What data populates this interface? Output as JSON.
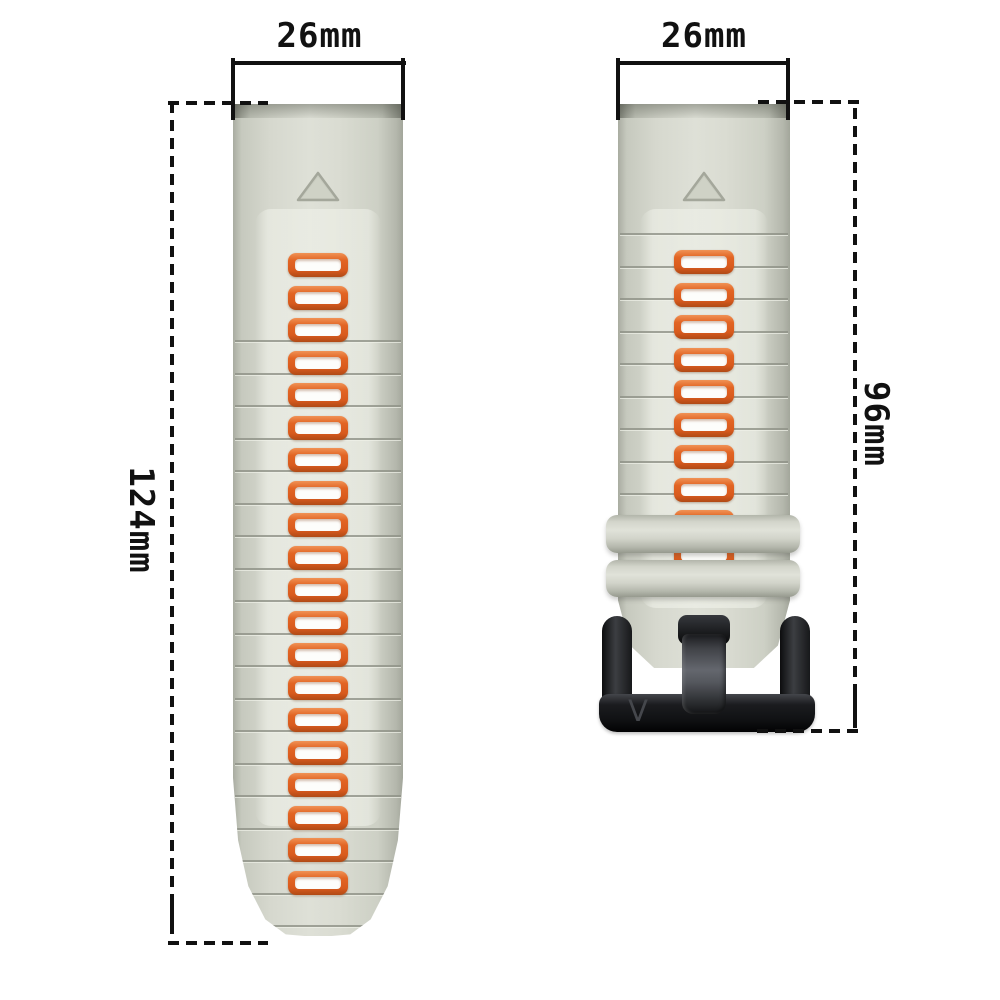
{
  "annotations": {
    "left_width_label": "26mm",
    "right_width_label": "26mm",
    "left_length_label": "124mm",
    "right_length_label": "96mm",
    "line_color": "#111111"
  },
  "product": {
    "left_strap": {
      "slot_count": 20,
      "marker": "triangle",
      "band_color": "#d6d8ce",
      "slot_color": "#dd5f22"
    },
    "right_strap": {
      "slot_count": 10,
      "keeper_count": 2,
      "marker": "triangle",
      "band_color": "#d6d8ce",
      "slot_color": "#dd5f22"
    },
    "buckle": {
      "logo_text": "V",
      "color": "#1a1b1d"
    }
  }
}
